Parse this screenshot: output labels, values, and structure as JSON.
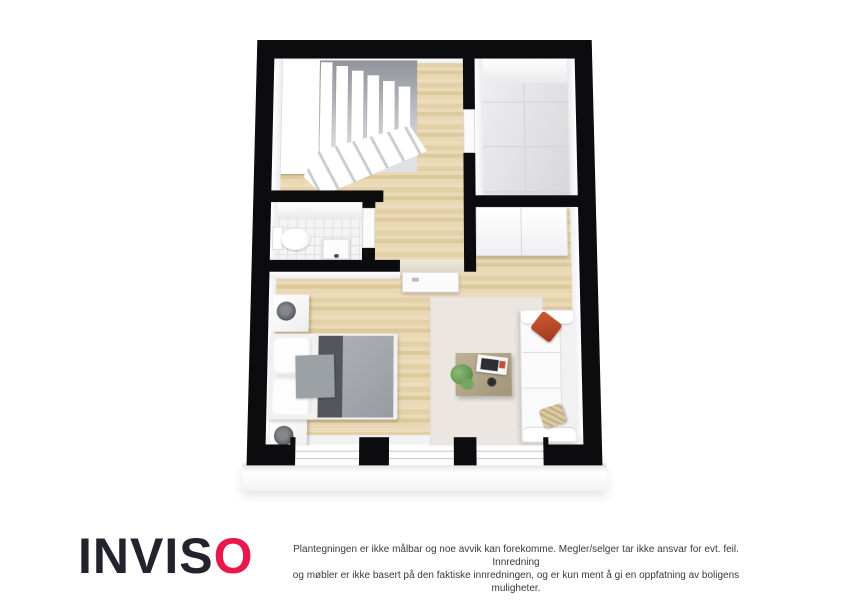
{
  "branding": {
    "logo_main": "INVIS",
    "logo_accent": "O",
    "logo_color": "#23232e",
    "accent_color": "#e9174a"
  },
  "disclaimer": {
    "line1": "Plantegningen er ikke målbar og noe avvik kan forekomme. Megler/selger tar ikke ansvar for evt. feil. Innredning",
    "line2": "og møbler er ikke basert på den faktiske innredningen, og er kun ment å gi en oppfatning av boligens muligheter."
  },
  "floorplan": {
    "style": "3d-top-down-floor-plan",
    "wall_color": "#0c0c0e",
    "floor_colors": {
      "wood": "#e7d6b0",
      "storage_tile": "#e3e3e6",
      "bathroom_tile": "#f4f4f4",
      "rug": "#ebe6e1"
    },
    "rooms": [
      {
        "name": "hall-with-staircase",
        "floor": "wood"
      },
      {
        "name": "storage-room",
        "floor": "gray-tile"
      },
      {
        "name": "bathroom",
        "floor": "white-tile",
        "fixtures": [
          "toilet",
          "sink"
        ]
      },
      {
        "name": "living-bedroom",
        "floor": "wood",
        "furniture": [
          "double-bed",
          "nightstand-with-lamp",
          "nightstand-with-lamp",
          "wardrobe",
          "sofa",
          "coffee-table",
          "rug",
          "plant",
          "magazines"
        ]
      }
    ],
    "features": {
      "staircase_steps": "winder staircase, white",
      "windows_bottom_wall": 3,
      "doors": [
        "storage-door",
        "bathroom-door",
        "living-room-door"
      ],
      "sofa_pillows": [
        "red",
        "beige-patterned"
      ]
    }
  }
}
